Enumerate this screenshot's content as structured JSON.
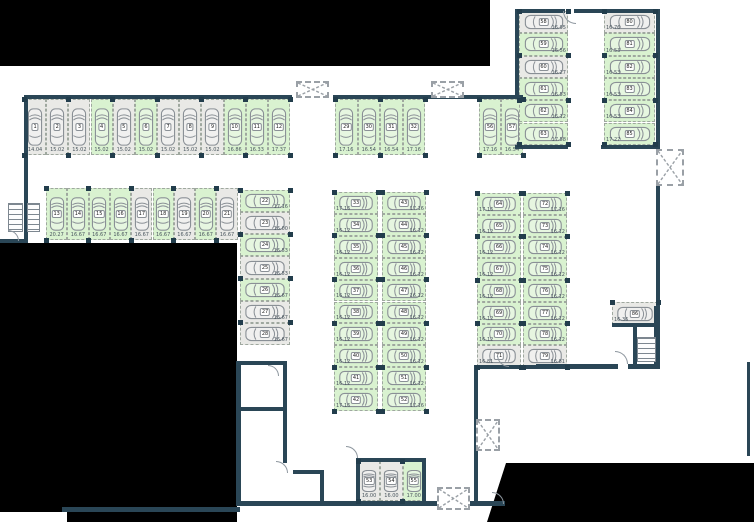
{
  "title": "underground parking level plan",
  "colors": {
    "available_space": "#d9f2d0",
    "occupied_space": "#e9e9e6",
    "wall": "#2a4656",
    "masked_area": "#000000",
    "car_outline": "#8a9096",
    "dimension_text": "#49555e"
  },
  "plan": {
    "groups": [
      {
        "name": "row-top-left",
        "type": "row",
        "x": 24,
        "y": 99,
        "cw": 22.17,
        "ch": 56,
        "label": "b",
        "spaces": [
          {
            "n": "1",
            "d": "14.04",
            "state": "gray"
          },
          {
            "n": "2",
            "d": "15.02",
            "state": "gray"
          },
          {
            "n": "3",
            "d": "15.02",
            "state": "gray"
          },
          {
            "n": "4",
            "d": "15.02",
            "state": "green"
          },
          {
            "n": "5",
            "d": "15.02",
            "state": "gray"
          },
          {
            "n": "6",
            "d": "15.02",
            "state": "green"
          },
          {
            "n": "7",
            "d": "15.02",
            "state": "gray"
          },
          {
            "n": "8",
            "d": "15.02",
            "state": "gray"
          },
          {
            "n": "9",
            "d": "15.02",
            "state": "gray"
          },
          {
            "n": "10",
            "d": "16.86",
            "state": "green"
          },
          {
            "n": "11",
            "d": "16.33",
            "state": "green"
          },
          {
            "n": "12",
            "d": "17.37",
            "state": "green"
          }
        ]
      },
      {
        "name": "row-second-left",
        "type": "row",
        "x": 46,
        "y": 188,
        "cw": 21.3,
        "ch": 52,
        "label": "b",
        "spaces": [
          {
            "n": "13",
            "d": "20.27",
            "state": "green"
          },
          {
            "n": "14",
            "d": "16.67",
            "state": "green"
          },
          {
            "n": "15",
            "d": "16.67",
            "state": "green"
          },
          {
            "n": "16",
            "d": "16.67",
            "state": "green"
          },
          {
            "n": "17",
            "d": "16.67",
            "state": "gray"
          },
          {
            "n": "18",
            "d": "16.67",
            "state": "green"
          },
          {
            "n": "19",
            "d": "16.67",
            "state": "gray"
          },
          {
            "n": "20",
            "d": "16.67",
            "state": "green"
          },
          {
            "n": "21",
            "d": "16.67",
            "state": "gray"
          }
        ]
      },
      {
        "name": "col-left-middle",
        "type": "col",
        "x": 240,
        "y": 190,
        "cw": 50,
        "ch": 22.15,
        "label": "r",
        "spaces": [
          {
            "n": "22",
            "d": "17.16",
            "state": "green"
          },
          {
            "n": "23",
            "d": "16.00",
            "state": "gray"
          },
          {
            "n": "24",
            "d": "16.53",
            "state": "green"
          },
          {
            "n": "25",
            "d": "16.53",
            "state": "gray"
          },
          {
            "n": "26",
            "d": "16.67",
            "state": "green"
          },
          {
            "n": "27",
            "d": "16.67",
            "state": "gray"
          },
          {
            "n": "28",
            "d": "16.67",
            "state": "gray"
          }
        ]
      },
      {
        "name": "row-top-middle",
        "type": "row",
        "x": 335,
        "y": 99,
        "cw": 22.5,
        "ch": 56,
        "label": "b",
        "spaces": [
          {
            "n": "29",
            "d": "17.16",
            "state": "green"
          },
          {
            "n": "30",
            "d": "16.54",
            "state": "green"
          },
          {
            "n": "31",
            "d": "16.54",
            "state": "green"
          },
          {
            "n": "32",
            "d": "17.16",
            "state": "green"
          }
        ]
      },
      {
        "name": "col-center-west",
        "type": "col",
        "x": 334,
        "y": 192,
        "cw": 44,
        "ch": 21.9,
        "label": "l",
        "spaces": [
          {
            "n": "33",
            "d": "17.16",
            "state": "green"
          },
          {
            "n": "34",
            "d": "16.12",
            "state": "green"
          },
          {
            "n": "35",
            "d": "16.12",
            "state": "green"
          },
          {
            "n": "36",
            "d": "16.12",
            "state": "green"
          },
          {
            "n": "37",
            "d": "16.12",
            "state": "green"
          },
          {
            "n": "38",
            "d": "16.12",
            "state": "green"
          },
          {
            "n": "39",
            "d": "16.12",
            "state": "green"
          },
          {
            "n": "40",
            "d": "16.12",
            "state": "green"
          },
          {
            "n": "41",
            "d": "16.12",
            "state": "green"
          },
          {
            "n": "42",
            "d": "17.16",
            "state": "green"
          }
        ]
      },
      {
        "name": "col-center-east",
        "type": "col",
        "x": 382,
        "y": 192,
        "cw": 44,
        "ch": 21.9,
        "label": "r",
        "spaces": [
          {
            "n": "43",
            "d": "17.16",
            "state": "green"
          },
          {
            "n": "44",
            "d": "16.12",
            "state": "green"
          },
          {
            "n": "45",
            "d": "16.12",
            "state": "green"
          },
          {
            "n": "46",
            "d": "16.12",
            "state": "green"
          },
          {
            "n": "47",
            "d": "16.12",
            "state": "green"
          },
          {
            "n": "48",
            "d": "16.12",
            "state": "green"
          },
          {
            "n": "49",
            "d": "16.12",
            "state": "green"
          },
          {
            "n": "50",
            "d": "16.12",
            "state": "green"
          },
          {
            "n": "51",
            "d": "16.12",
            "state": "green"
          },
          {
            "n": "52",
            "d": "17.16",
            "state": "green"
          }
        ]
      },
      {
        "name": "row-bottom-garage",
        "type": "row",
        "x": 358,
        "y": 461,
        "cw": 22.3,
        "ch": 40,
        "label": "b",
        "spaces": [
          {
            "n": "53",
            "d": "16.00",
            "state": "gray"
          },
          {
            "n": "54",
            "d": "16.00",
            "state": "gray"
          },
          {
            "n": "55",
            "d": "17.00",
            "state": "green"
          }
        ]
      },
      {
        "name": "row-top-right-pair",
        "type": "row",
        "x": 479,
        "y": 99,
        "cw": 22,
        "ch": 56,
        "label": "b",
        "spaces": [
          {
            "n": "56",
            "d": "17.16",
            "state": "green"
          },
          {
            "n": "57",
            "d": "16.54",
            "state": "green"
          }
        ]
      },
      {
        "name": "col-upper-right-inner",
        "type": "col",
        "x": 519,
        "y": 11,
        "cw": 49,
        "ch": 22.3,
        "label": "r",
        "spaces": [
          {
            "n": "58",
            "d": "16.95",
            "state": "gray"
          },
          {
            "n": "59",
            "d": "16.56",
            "state": "green"
          },
          {
            "n": "60",
            "d": "16.27",
            "state": "gray"
          },
          {
            "n": "61",
            "d": "16.53",
            "state": "green"
          },
          {
            "n": "62",
            "d": "16.12",
            "state": "green"
          },
          {
            "n": "63",
            "d": "17.58",
            "state": "green"
          }
        ]
      },
      {
        "name": "col-right-middle-west",
        "type": "col",
        "x": 477,
        "y": 193,
        "cw": 44,
        "ch": 21.75,
        "label": "l",
        "spaces": [
          {
            "n": "64",
            "d": "17.16",
            "state": "green"
          },
          {
            "n": "65",
            "d": "16.12",
            "state": "green"
          },
          {
            "n": "66",
            "d": "16.12",
            "state": "green"
          },
          {
            "n": "67",
            "d": "16.12",
            "state": "green"
          },
          {
            "n": "68",
            "d": "16.12",
            "state": "green"
          },
          {
            "n": "69",
            "d": "16.12",
            "state": "green"
          },
          {
            "n": "70",
            "d": "16.12",
            "state": "green"
          },
          {
            "n": "71",
            "d": "16.81",
            "state": "gray"
          }
        ]
      },
      {
        "name": "col-right-middle-east",
        "type": "col",
        "x": 523,
        "y": 193,
        "cw": 44,
        "ch": 21.75,
        "label": "r",
        "spaces": [
          {
            "n": "72",
            "d": "17.16",
            "state": "green"
          },
          {
            "n": "73",
            "d": "16.12",
            "state": "green"
          },
          {
            "n": "74",
            "d": "16.12",
            "state": "green"
          },
          {
            "n": "75",
            "d": "16.12",
            "state": "green"
          },
          {
            "n": "76",
            "d": "16.12",
            "state": "green"
          },
          {
            "n": "77",
            "d": "16.12",
            "state": "green"
          },
          {
            "n": "78",
            "d": "16.12",
            "state": "green"
          },
          {
            "n": "79",
            "d": "16.81",
            "state": "gray"
          }
        ]
      },
      {
        "name": "col-upper-right-outer",
        "type": "col",
        "x": 604,
        "y": 11,
        "cw": 51,
        "ch": 22.3,
        "label": "l",
        "spaces": [
          {
            "n": "80",
            "d": "16.76",
            "state": "gray"
          },
          {
            "n": "81",
            "d": "16.53",
            "state": "green"
          },
          {
            "n": "82",
            "d": "16.53",
            "state": "green"
          },
          {
            "n": "83",
            "d": "16.53",
            "state": "green"
          },
          {
            "n": "84",
            "d": "16.53",
            "state": "green"
          },
          {
            "n": "85",
            "d": "17.27",
            "state": "green"
          }
        ]
      },
      {
        "name": "single-right",
        "type": "col",
        "x": 612,
        "y": 302,
        "cw": 46,
        "ch": 23,
        "label": "l",
        "spaces": [
          {
            "n": "86",
            "d": "16.36",
            "state": "gray"
          }
        ]
      }
    ],
    "walls": [
      {
        "x": 24,
        "y": 95,
        "w": 268,
        "h": 4
      },
      {
        "x": 24,
        "y": 95,
        "w": 4,
        "h": 148
      },
      {
        "x": 0,
        "y": 239,
        "w": 28,
        "h": 4
      },
      {
        "x": 333,
        "y": 95,
        "w": 190,
        "h": 4
      },
      {
        "x": 515,
        "y": 9,
        "w": 4,
        "h": 90
      },
      {
        "x": 515,
        "y": 9,
        "w": 50,
        "h": 4
      },
      {
        "x": 574,
        "y": 9,
        "w": 86,
        "h": 4
      },
      {
        "x": 656,
        "y": 9,
        "w": 4,
        "h": 140
      },
      {
        "x": 656,
        "y": 186,
        "w": 4,
        "h": 122
      },
      {
        "x": 515,
        "y": 145,
        "w": 53,
        "h": 4
      },
      {
        "x": 601,
        "y": 145,
        "w": 59,
        "h": 4
      },
      {
        "x": 236,
        "y": 361,
        "w": 5,
        "h": 145
      },
      {
        "x": 237,
        "y": 361,
        "w": 50,
        "h": 4
      },
      {
        "x": 283,
        "y": 361,
        "w": 4,
        "h": 50
      },
      {
        "x": 237,
        "y": 407,
        "w": 50,
        "h": 4
      },
      {
        "x": 283,
        "y": 411,
        "w": 4,
        "h": 52
      },
      {
        "x": 293,
        "y": 470,
        "w": 31,
        "h": 4
      },
      {
        "x": 320,
        "y": 470,
        "w": 4,
        "h": 34
      },
      {
        "x": 237,
        "y": 501,
        "w": 268,
        "h": 5
      },
      {
        "x": 62,
        "y": 507,
        "w": 178,
        "h": 5
      },
      {
        "x": 356,
        "y": 458,
        "w": 70,
        "h": 4
      },
      {
        "x": 356,
        "y": 458,
        "w": 4,
        "h": 47
      },
      {
        "x": 422,
        "y": 458,
        "w": 4,
        "h": 47
      },
      {
        "x": 474,
        "y": 365,
        "w": 96,
        "h": 4
      },
      {
        "x": 474,
        "y": 365,
        "w": 4,
        "h": 140
      },
      {
        "x": 612,
        "y": 323,
        "w": 46,
        "h": 4
      },
      {
        "x": 633,
        "y": 323,
        "w": 4,
        "h": 45
      },
      {
        "x": 536,
        "y": 364,
        "w": 82,
        "h": 5
      },
      {
        "x": 628,
        "y": 364,
        "w": 32,
        "h": 5
      },
      {
        "x": 654,
        "y": 306,
        "w": 6,
        "h": 62
      },
      {
        "x": 747,
        "y": 362,
        "w": 3,
        "h": 94
      }
    ],
    "black_regions": [
      {
        "x": 0,
        "y": 0,
        "w": 490,
        "h": 66
      },
      {
        "points": [
          [
            0,
            243
          ],
          [
            237,
            243
          ],
          [
            237,
            522
          ],
          [
            67,
            522
          ],
          [
            67,
            512
          ],
          [
            0,
            512
          ]
        ]
      },
      {
        "points": [
          [
            506,
            463
          ],
          [
            754,
            463
          ],
          [
            754,
            522
          ],
          [
            487,
            522
          ]
        ]
      }
    ],
    "shafts": [
      {
        "x": 296,
        "y": 81,
        "w": 33,
        "h": 17
      },
      {
        "x": 431,
        "y": 81,
        "w": 33,
        "h": 17
      },
      {
        "x": 656,
        "y": 149,
        "w": 28,
        "h": 37
      },
      {
        "x": 476,
        "y": 419,
        "w": 24,
        "h": 32
      },
      {
        "x": 437,
        "y": 487,
        "w": 33,
        "h": 23
      }
    ],
    "stairs": [
      {
        "x": 8,
        "y": 203,
        "w": 15,
        "h": 29
      },
      {
        "x": 27,
        "y": 203,
        "w": 13,
        "h": 29
      },
      {
        "x": 637,
        "y": 337,
        "w": 19,
        "h": 25
      }
    ],
    "doors": [
      {
        "x": 563,
        "y": 11,
        "r": 13,
        "q": "sw"
      },
      {
        "x": 8,
        "y": 230,
        "r": 11,
        "q": "ne"
      },
      {
        "x": 268,
        "y": 365,
        "r": 11,
        "q": "ne"
      },
      {
        "x": 276,
        "y": 461,
        "r": 12,
        "q": "ne"
      },
      {
        "x": 346,
        "y": 446,
        "r": 12,
        "q": "ne"
      },
      {
        "x": 497,
        "y": 355,
        "r": 12,
        "q": "sw"
      },
      {
        "x": 615,
        "y": 351,
        "r": 13,
        "q": "ne"
      },
      {
        "x": 492,
        "y": 492,
        "r": 12,
        "q": "ne"
      }
    ]
  }
}
